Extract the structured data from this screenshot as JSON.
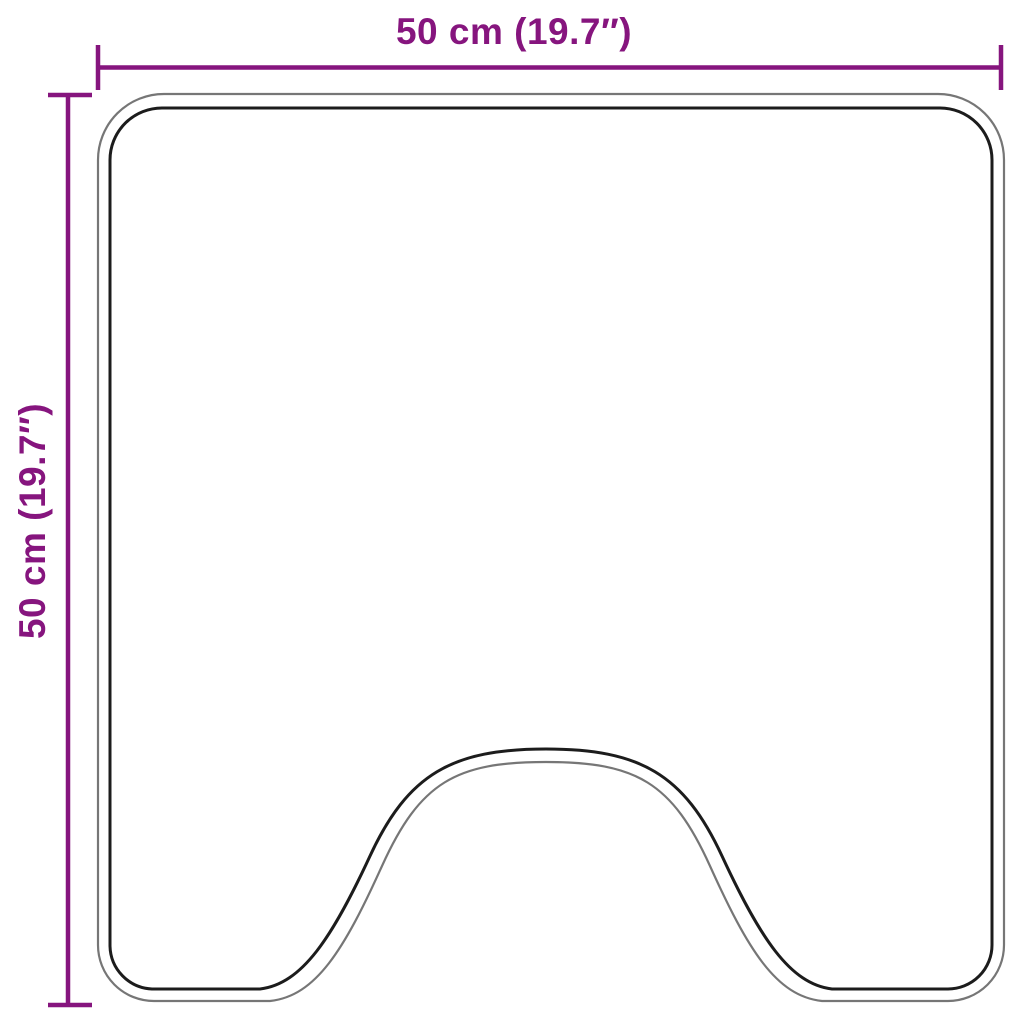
{
  "diagram": {
    "type": "product-dimension-outline",
    "subject": "bath mat with pedestal cut-out, top view outline",
    "width": {
      "label": "50 cm (19.7″)",
      "value_cm": 50,
      "value_inches": 19.7
    },
    "height": {
      "label": "50 cm (19.7″)",
      "value_cm": 50,
      "value_inches": 19.7
    }
  },
  "colors": {
    "dimension_accent": "#86157E",
    "outline_outer": "#767676",
    "outline_inner": "#1C1C1C",
    "background": "#FFFFFF"
  }
}
